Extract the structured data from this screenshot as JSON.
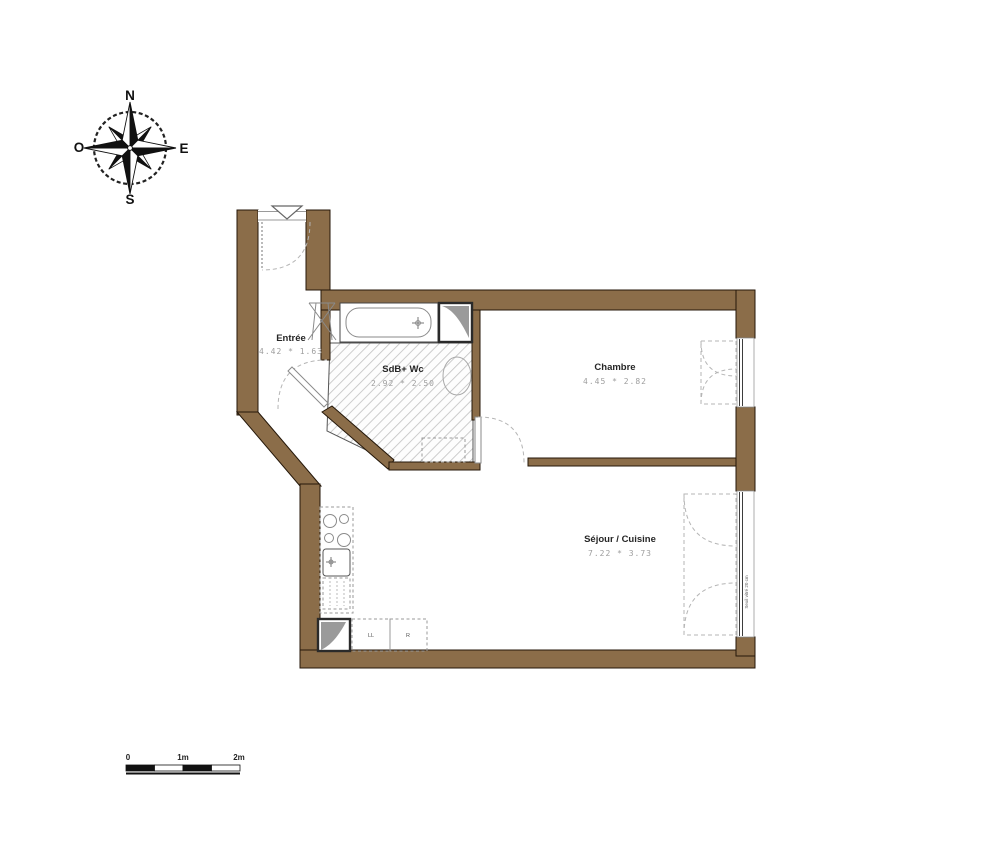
{
  "compass": {
    "north": "N",
    "east": "E",
    "south": "S",
    "west": "O"
  },
  "rooms": {
    "entree": {
      "name": "Entrée",
      "dims": "4.42 * 1.63"
    },
    "sdb": {
      "name": "SdB+ Wc",
      "dims": "2.92 * 2.50"
    },
    "chambre": {
      "name": "Chambre",
      "dims": "4.45 * 2.82"
    },
    "sejour": {
      "name": "Séjour / Cuisine",
      "dims": "7.22 * 3.73"
    }
  },
  "appliances": {
    "washing_machine": "LL",
    "fridge": "R"
  },
  "annotations": {
    "window_note": "Seuil vitré 20 cm"
  },
  "scale_bar": {
    "labels": [
      "0",
      "1m",
      "2m"
    ]
  },
  "colors": {
    "wall": "#8b6d49",
    "hatch_line": "#c4c4c4",
    "dim_text": "#9e9e9e"
  }
}
